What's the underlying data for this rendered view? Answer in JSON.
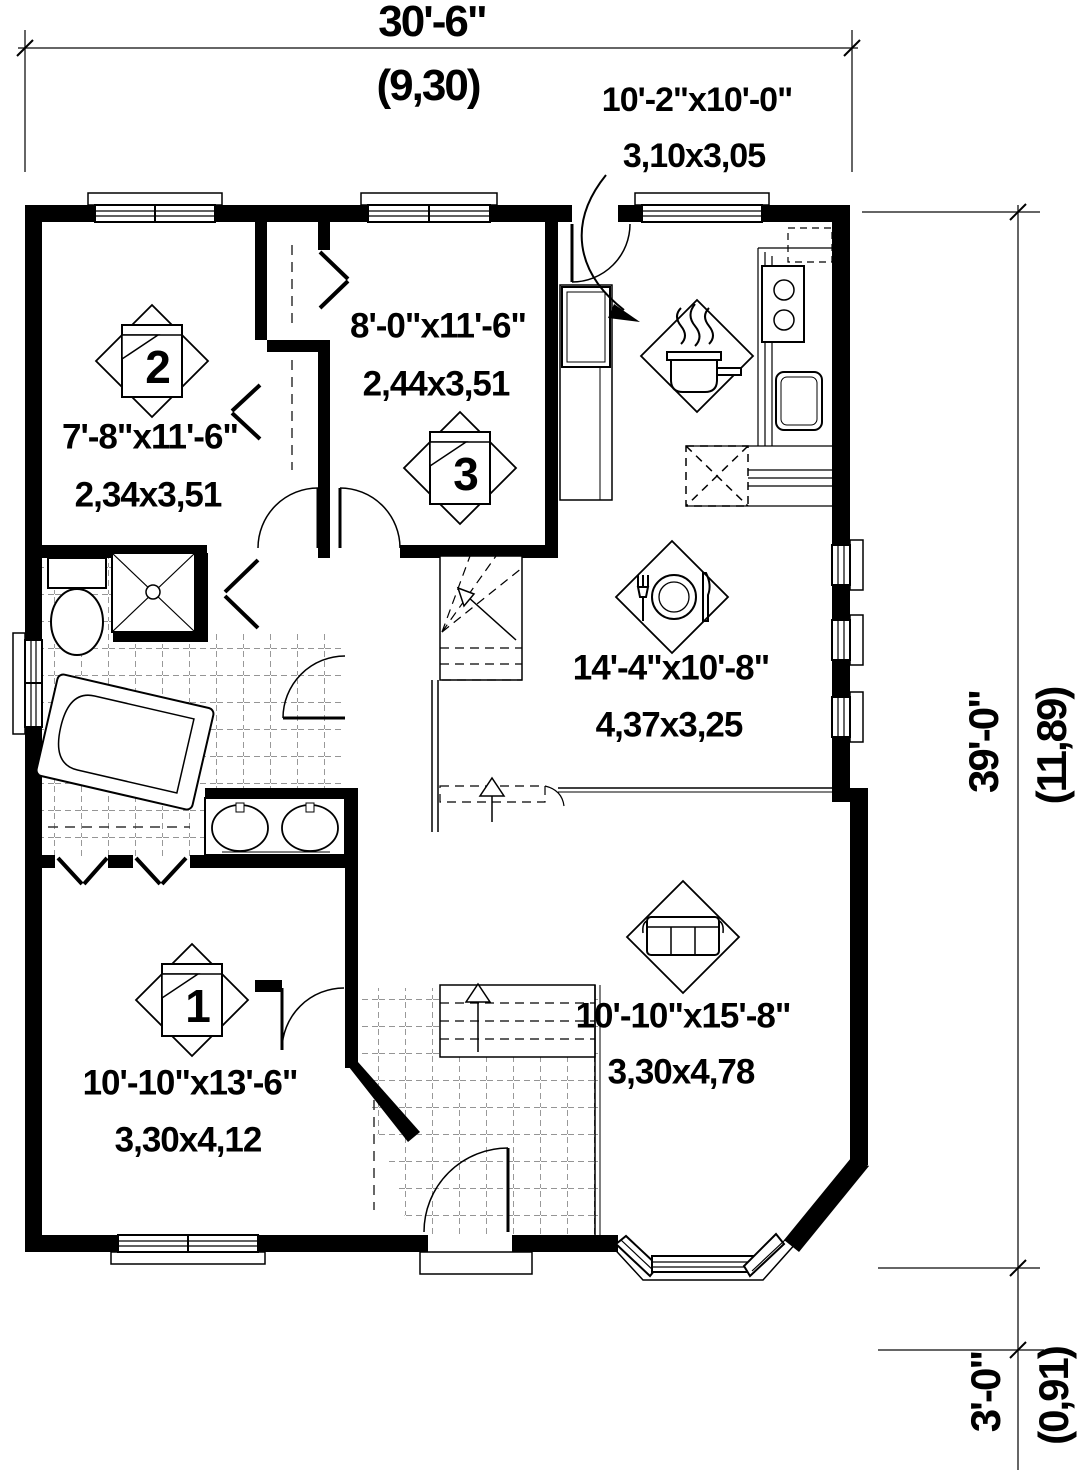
{
  "drawing_type": "first-floor-plan",
  "colors": {
    "wall": "#000000",
    "line": "#1a1a1a",
    "tile_line": "#555555",
    "background": "#ffffff"
  },
  "dimensions": {
    "overall_width": {
      "imperial": "30'-6\"",
      "metric": "(9,30)"
    },
    "overall_height": {
      "imperial": "39'-0\"",
      "metric": "(11,89)"
    },
    "bay_depth": {
      "imperial": "3'-0\"",
      "metric": "(0,91)"
    }
  },
  "rooms": [
    {
      "name": "kitchen",
      "imperial": "10'-2\"x10'-0\"",
      "metric": "3,10x3,05",
      "icon": "cooking-pot-icon"
    },
    {
      "name": "bedroom-3",
      "imperial": "8'-0\"x11'-6\"",
      "metric": "2,44x3,51",
      "icon": "bed-icon",
      "number": "3"
    },
    {
      "name": "bedroom-2",
      "imperial": "7'-8\"x11'-6\"",
      "metric": "2,34x3,51",
      "icon": "bed-icon",
      "number": "2"
    },
    {
      "name": "dining",
      "imperial": "14'-4\"x10'-8\"",
      "metric": "4,37x3,25",
      "icon": "place-setting-icon"
    },
    {
      "name": "living",
      "imperial": "10'-10\"x15'-8\"",
      "metric": "3,30x4,78",
      "icon": "sofa-icon"
    },
    {
      "name": "bedroom-1",
      "imperial": "10'-10\"x13'-6\"",
      "metric": "3,30x4,12",
      "icon": "bed-icon",
      "number": "1"
    }
  ]
}
